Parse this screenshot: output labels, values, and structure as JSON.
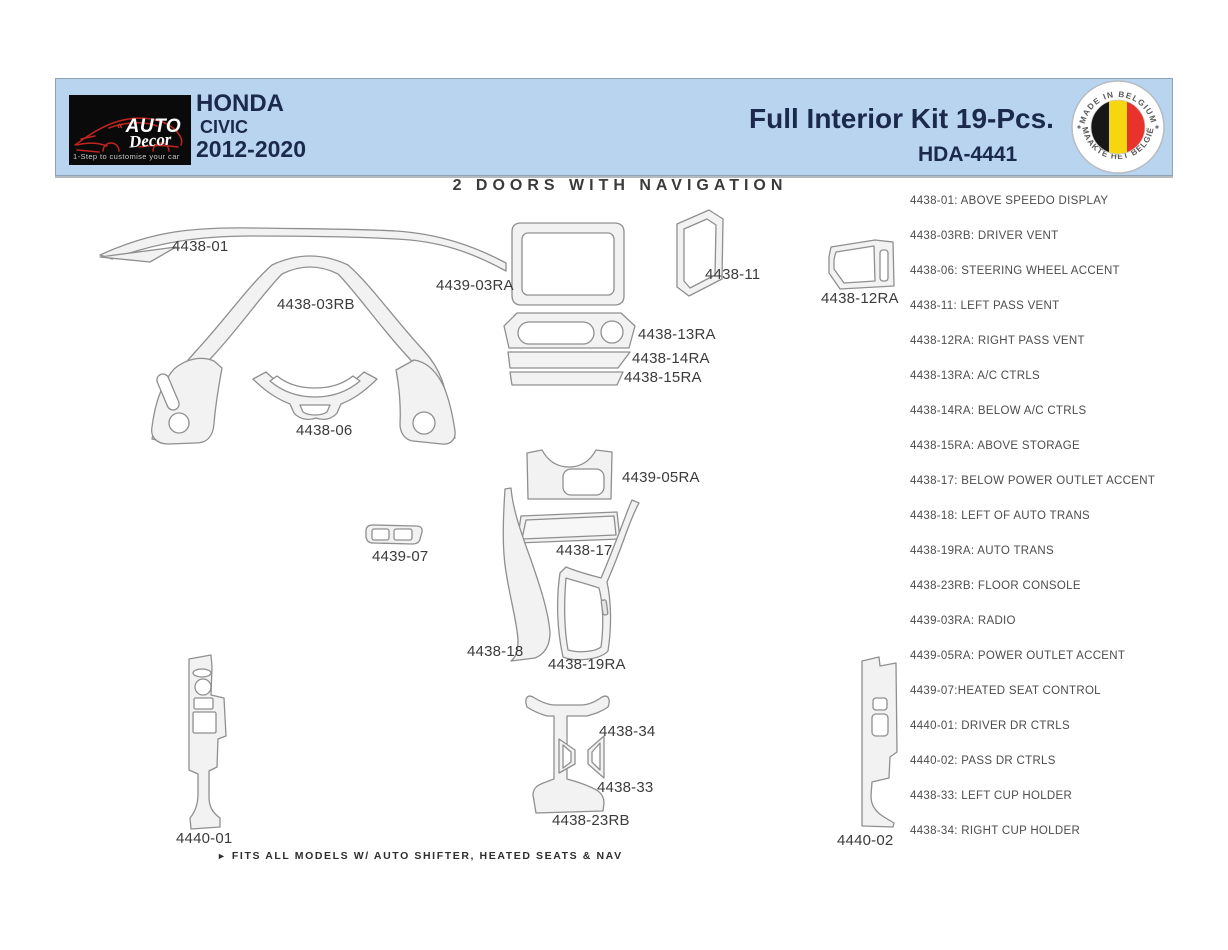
{
  "header": {
    "logo": {
      "mark": "«",
      "brand": "AUTO",
      "script": "Decor",
      "tagline": "1-Step to customise your car"
    },
    "make": "HONDA",
    "model": "CIVIC",
    "years": "2012-2020",
    "kit_title": "Full Interior Kit 19-Pcs.",
    "part_number": "HDA-4441",
    "badge": {
      "top": "MADE IN BELGIUM",
      "bottom": "MAAKTE HET BELGIË"
    },
    "colors": {
      "header_bg": "#b9d4ef",
      "navy_text": "#1b2a4c",
      "logo_bg": "#0a0a0a",
      "logo_red": "#c0251f",
      "belgium_black": "#171717",
      "belgium_yellow": "#f6d60f",
      "belgium_red": "#e8332c"
    }
  },
  "diagram": {
    "title": "2 DOORS WITH NAVIGATION",
    "labels": [
      "4438-01",
      "4438-03RB",
      "4439-03RA",
      "4438-11",
      "4438-12RA",
      "4438-13RA",
      "4438-14RA",
      "4438-15RA",
      "4438-06",
      "4439-05RA",
      "4438-17",
      "4439-07",
      "4438-18",
      "4438-19RA",
      "4438-34",
      "4438-33",
      "4438-23RB",
      "4440-01",
      "4440-02"
    ],
    "footnote_marker": "►",
    "footnote": "FITS ALL MODELS W/ AUTO SHIFTER, HEATED SEATS & NAV"
  },
  "legend": {
    "items": [
      "4438-01: ABOVE SPEEDO DISPLAY",
      "4438-03RB: DRIVER VENT",
      "4438-06: STEERING WHEEL ACCENT",
      "4438-11: LEFT PASS VENT",
      "4438-12RA: RIGHT PASS VENT",
      "4438-13RA: A/C CTRLS",
      "4438-14RA: BELOW A/C CTRLS",
      "4438-15RA: ABOVE STORAGE",
      "4438-17: BELOW POWER OUTLET ACCENT",
      "4438-18: LEFT OF AUTO TRANS",
      "4438-19RA: AUTO TRANS",
      "4438-23RB: FLOOR CONSOLE",
      "4439-03RA: RADIO",
      "4439-05RA: POWER OUTLET ACCENT",
      "4439-07:HEATED SEAT CONTROL",
      "4440-01: DRIVER DR CTRLS",
      "4440-02: PASS DR CTRLS",
      "4438-33: LEFT CUP HOLDER",
      "4438-34: RIGHT CUP HOLDER"
    ]
  }
}
